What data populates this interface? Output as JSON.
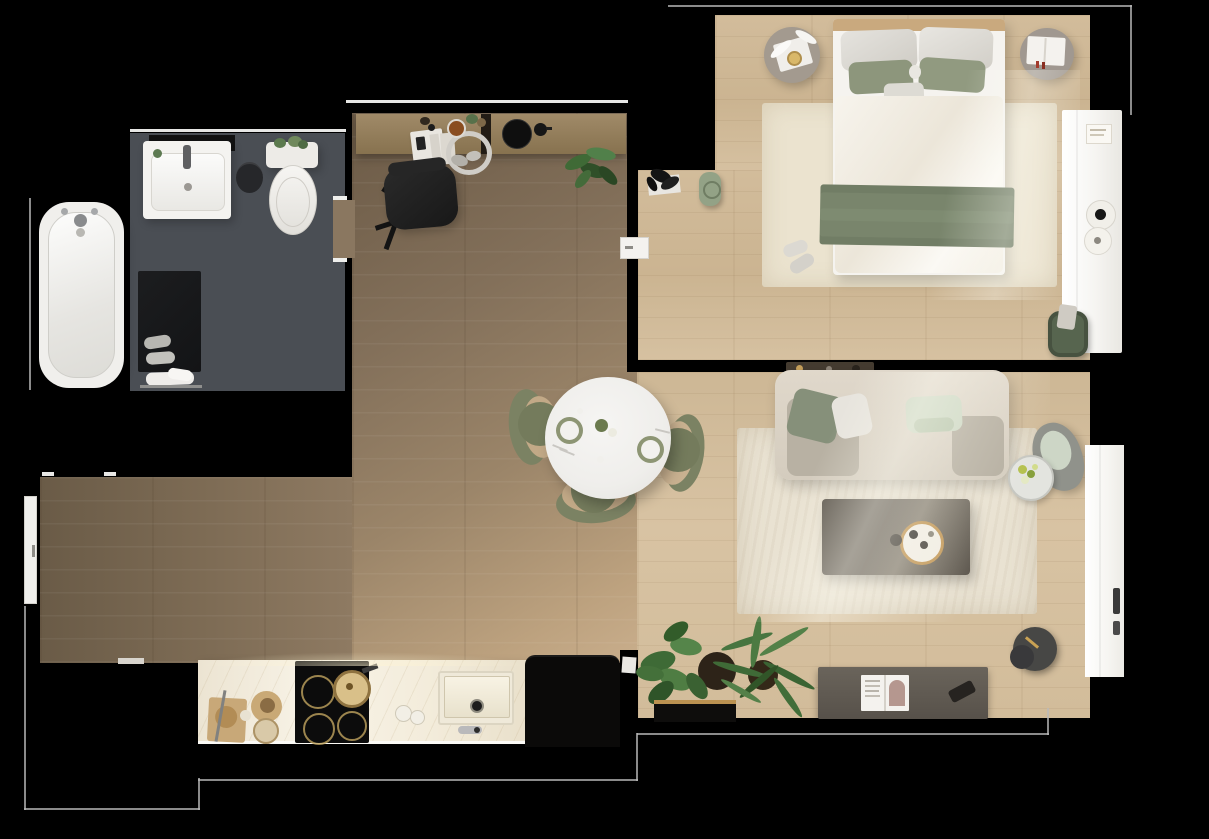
{
  "scene": {
    "title": "Top-down 3D rendered apartment floor plan",
    "background_color": "#000000",
    "visible_text": "none"
  },
  "palette": {
    "floor_oak_dark": "#83705a",
    "floor_oak_light": "#d2bc9a",
    "bathroom_tile": "#4a4e54",
    "marble_counter": "#f3ecdb",
    "sage_green": "#87917a",
    "olive_chair": "#7b8263",
    "mint": "#ccd7c3",
    "furniture_gray": "#5d574e",
    "white_goods": "#f5f3ef",
    "plant_green": "#46703a",
    "brass": "#c39a58",
    "outline_gray": "#b9b9b9"
  },
  "rooms": [
    {
      "name": "bathroom",
      "items": [
        "bathtub",
        "vanity-sink",
        "toilet",
        "waste-bin",
        "bath-mat",
        "slippers",
        "towels",
        "door-opening"
      ]
    },
    {
      "name": "study-hall",
      "items": [
        "desk",
        "office-chair",
        "notebook",
        "headphones",
        "speaker",
        "desk-plant",
        "entry-door",
        "window"
      ]
    },
    {
      "name": "dining-area",
      "items": [
        "round-dining-table",
        "dining-chair-left",
        "dining-chair-right",
        "dining-chair-bottom",
        "place-setting-left",
        "place-setting-right",
        "centerpiece"
      ]
    },
    {
      "name": "kitchen",
      "items": [
        "marble-countertop",
        "cooktop",
        "frying-pan",
        "kitchen-sink",
        "faucet",
        "cutting-board",
        "teapot",
        "storage-jars",
        "refrigerator"
      ]
    },
    {
      "name": "bedroom",
      "items": [
        "double-bed",
        "headboard",
        "pillows",
        "duvet",
        "throw-blanket",
        "nightstand-left",
        "nightstand-right",
        "bedroom-rug",
        "slippers",
        "yoga-mat",
        "dried-plant-decor",
        "laundry-basket",
        "wardrobe",
        "bedroom-door"
      ]
    },
    {
      "name": "living-room",
      "items": [
        "sofa",
        "sofa-pillows",
        "armchair",
        "flower-side-table",
        "coffee-table",
        "serving-tray",
        "living-rug",
        "wall-shelf",
        "sideboard",
        "magazine",
        "remote-control",
        "lamp-side-table",
        "monstera-plant",
        "palm-plant",
        "bench",
        "balcony-window",
        "sunlight"
      ]
    }
  ]
}
